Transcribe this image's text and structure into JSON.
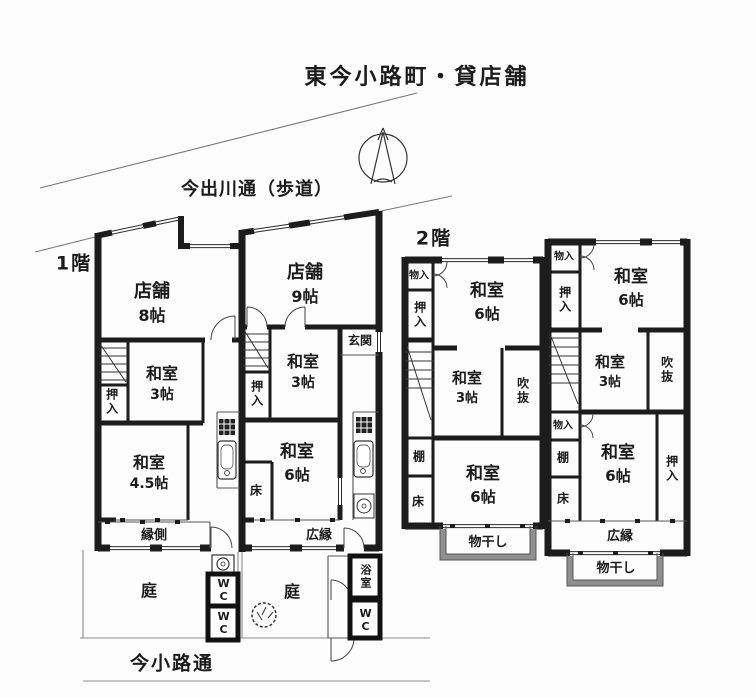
{
  "title": "東今小路町・貸店舗",
  "streets": {
    "top": "今出川通（歩道）",
    "bottom": "今小路通"
  },
  "floors": {
    "first": "1階",
    "second": "2階"
  },
  "colors": {
    "wall": "#1c1c1c",
    "thin_line": "#333333",
    "road_line": "#777777",
    "balcony": "#8f8f8f"
  },
  "icons": {
    "north": "north-compass-arrow",
    "stove": "kitchen-stove-grid",
    "sink": "kitchen-sink",
    "washer": "washing-machine",
    "rock": "garden-stone"
  },
  "f1_left": {
    "shop": {
      "name": "店舗",
      "size": "8帖"
    },
    "washitsu3": {
      "name": "和室",
      "size": "3帖"
    },
    "oshiire": "押入",
    "washitsu45": {
      "name": "和室",
      "size": "4.5帖"
    },
    "engawa": "縁側",
    "garden": "庭",
    "wc_upper": "WC",
    "wc_lower": "WC"
  },
  "f1_right": {
    "shop": {
      "name": "店舗",
      "size": "9帖"
    },
    "genkan": "玄関",
    "oshiire": "押入",
    "washitsu3": {
      "name": "和室",
      "size": "3帖"
    },
    "washitsu6": {
      "name": "和室",
      "size": "6帖"
    },
    "toko": "床",
    "hiroen": "広縁",
    "garden": "庭",
    "bath": "浴室",
    "wc": "WC"
  },
  "f2_left": {
    "monoire": "物入",
    "oshiire": "押入",
    "washitsu6_top": {
      "name": "和室",
      "size": "6帖"
    },
    "washitsu3": {
      "name": "和室",
      "size": "3帖"
    },
    "fukinuke": "吹抜",
    "tana": "棚",
    "toko": "床",
    "washitsu6_bottom": {
      "name": "和室",
      "size": "6帖"
    },
    "monohoshi": "物干し"
  },
  "f2_right": {
    "monoire_top": "物入",
    "oshiire_left": "押入",
    "washitsu6_top": {
      "name": "和室",
      "size": "6帖"
    },
    "washitsu3": {
      "name": "和室",
      "size": "3帖"
    },
    "fukinuke": "吹抜",
    "monoire_mid": "物入",
    "tana": "棚",
    "toko": "床",
    "washitsu6_bottom": {
      "name": "和室",
      "size": "6帖"
    },
    "oshiire_right": "押入",
    "hiroen": "広縁",
    "monohoshi": "物干し"
  }
}
